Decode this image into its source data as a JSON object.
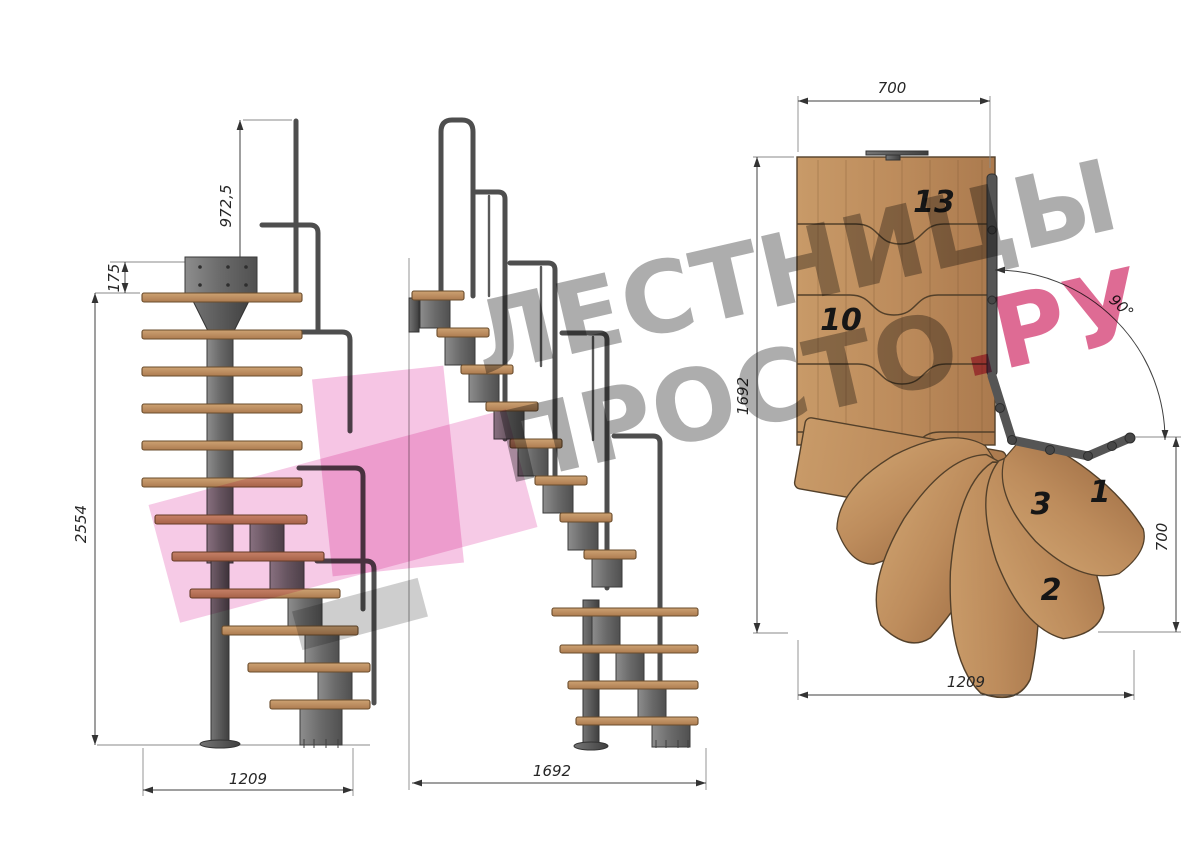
{
  "watermark": {
    "line1": "ЛЕСТНИЦЫ",
    "line2_gray": "ПРОСТО",
    "line2_pink": ".РУ"
  },
  "views": {
    "front": {
      "dims": {
        "handrail_height": "972,5",
        "top_offset": "175",
        "total_height": "2554",
        "width": "1209"
      }
    },
    "side": {
      "dims": {
        "length": "1692"
      }
    },
    "plan": {
      "dims": {
        "top_width": "700",
        "side_length": "1692",
        "turn_angle": "90°",
        "exit_depth": "700",
        "bottom_width": "1209"
      },
      "step_numbers": {
        "step13": "13",
        "step10": "10",
        "step1": "1",
        "step3": "3",
        "step2": "2"
      }
    }
  },
  "colors": {
    "wood": "#bf8f61",
    "metal": "#5a5a5a",
    "dimension_lines": "#3f3f3f",
    "watermark_gray": "#8f8f8f",
    "watermark_pink": "#cd1e5c",
    "logo_pink": "#ee96cd"
  }
}
